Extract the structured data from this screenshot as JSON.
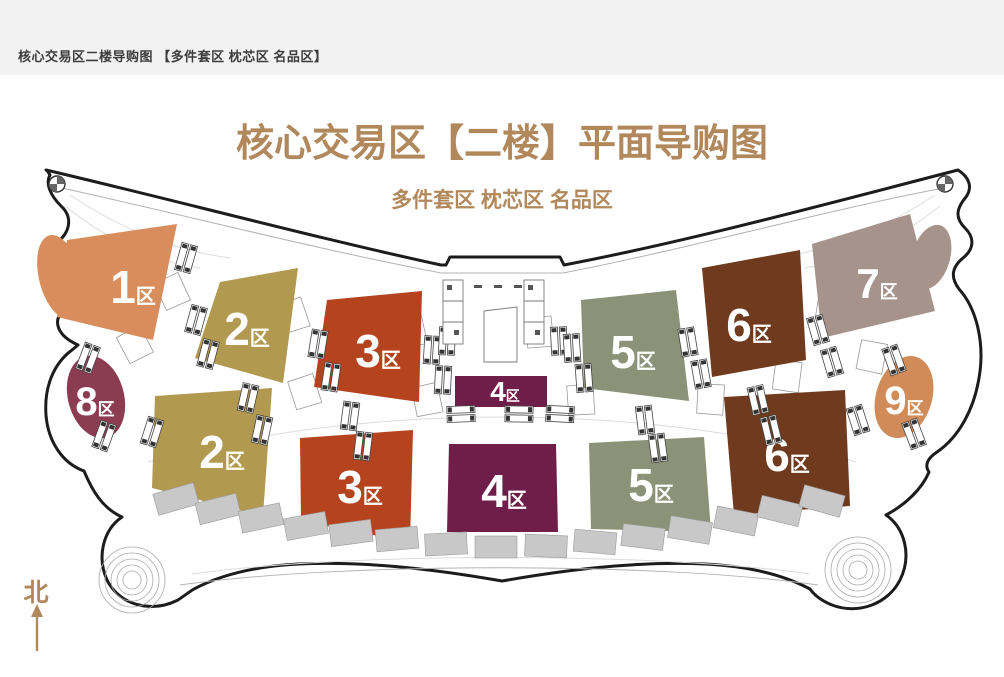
{
  "topbar": {
    "text": "核心交易区二楼导购图 【多件套区 枕芯区 名品区】"
  },
  "header": {
    "title": "核心交易区【二楼】平面导购图",
    "subtitle": "多件套区 枕芯区 名品区",
    "accent_color": "#b1885c"
  },
  "compass": {
    "label": "北"
  },
  "map": {
    "outline_color": "#1c1c1c",
    "shop_color": "#c8c8c8",
    "zones": [
      {
        "id": "zone-1",
        "number": "1",
        "suffix": "区",
        "color": "#d98d5c"
      },
      {
        "id": "zone-2",
        "number": "2",
        "suffix": "区",
        "color": "#b19a4f"
      },
      {
        "id": "zone-3",
        "number": "3",
        "suffix": "区",
        "color": "#b4431e"
      },
      {
        "id": "zone-4",
        "number": "4",
        "suffix": "区",
        "color": "#6e1e48"
      },
      {
        "id": "zone-5",
        "number": "5",
        "suffix": "区",
        "color": "#8c9277"
      },
      {
        "id": "zone-6",
        "number": "6",
        "suffix": "区",
        "color": "#6f3a1d"
      },
      {
        "id": "zone-7",
        "number": "7",
        "suffix": "区",
        "color": "#a6948c"
      },
      {
        "id": "zone-8",
        "number": "8",
        "suffix": "区",
        "color": "#8c3c51"
      },
      {
        "id": "zone-9",
        "number": "9",
        "suffix": "区",
        "color": "#d08b58"
      }
    ]
  }
}
